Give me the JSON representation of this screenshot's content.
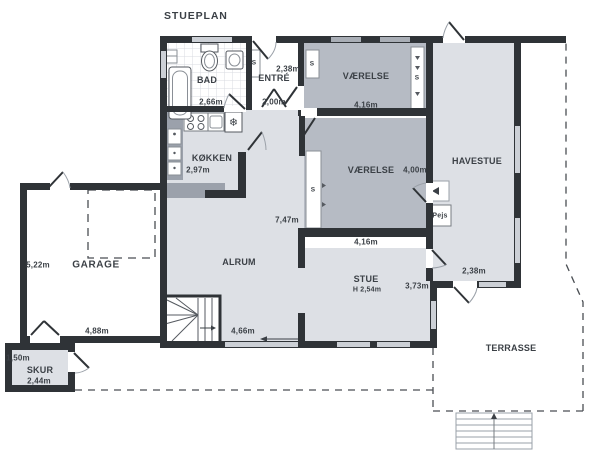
{
  "title": "STUEPLAN",
  "rooms": {
    "bad": {
      "name": "BAD",
      "width": "2,66m"
    },
    "entre": {
      "name": "ENTRÉ",
      "width": "2,38m",
      "depth": "2,00m"
    },
    "vaerelse_top": {
      "name": "VÆRELSE",
      "width": "4,16m"
    },
    "vaerelse_mid": {
      "name": "VÆRELSE",
      "depth": "4,00m",
      "width": "4,16m"
    },
    "havestue": {
      "name": "HAVESTUE",
      "exit_width": "2,38m"
    },
    "koekken": {
      "name": "KØKKEN",
      "width": "2,97m"
    },
    "alrum": {
      "name": "ALRUM",
      "depth": "7,47m",
      "width": "4,66m"
    },
    "stue": {
      "name": "STUE",
      "ceiling_height": "H 2,54m",
      "depth": "3,73m"
    },
    "garage": {
      "name": "GARAGE",
      "depth": "5,22m",
      "width": "4,88m"
    },
    "skur": {
      "name": "SKUR",
      "depth": "1,50m",
      "width": "2,44m"
    },
    "terrasse": {
      "name": "TERRASSE"
    },
    "pejs": {
      "name": "Pejs"
    }
  },
  "closet_label": "S",
  "icons": {
    "freezer-icon": "❄"
  },
  "colors": {
    "wall": "#2f3337",
    "room_light_grey": "#dde0e5",
    "room_mid_grey": "#b6bbc4",
    "counter_grey": "#9ba1ab",
    "window_light": "#ccd0d6",
    "window_dark": "#a9aeb6",
    "outline": "#8a8f96",
    "text": "#3b4046"
  }
}
